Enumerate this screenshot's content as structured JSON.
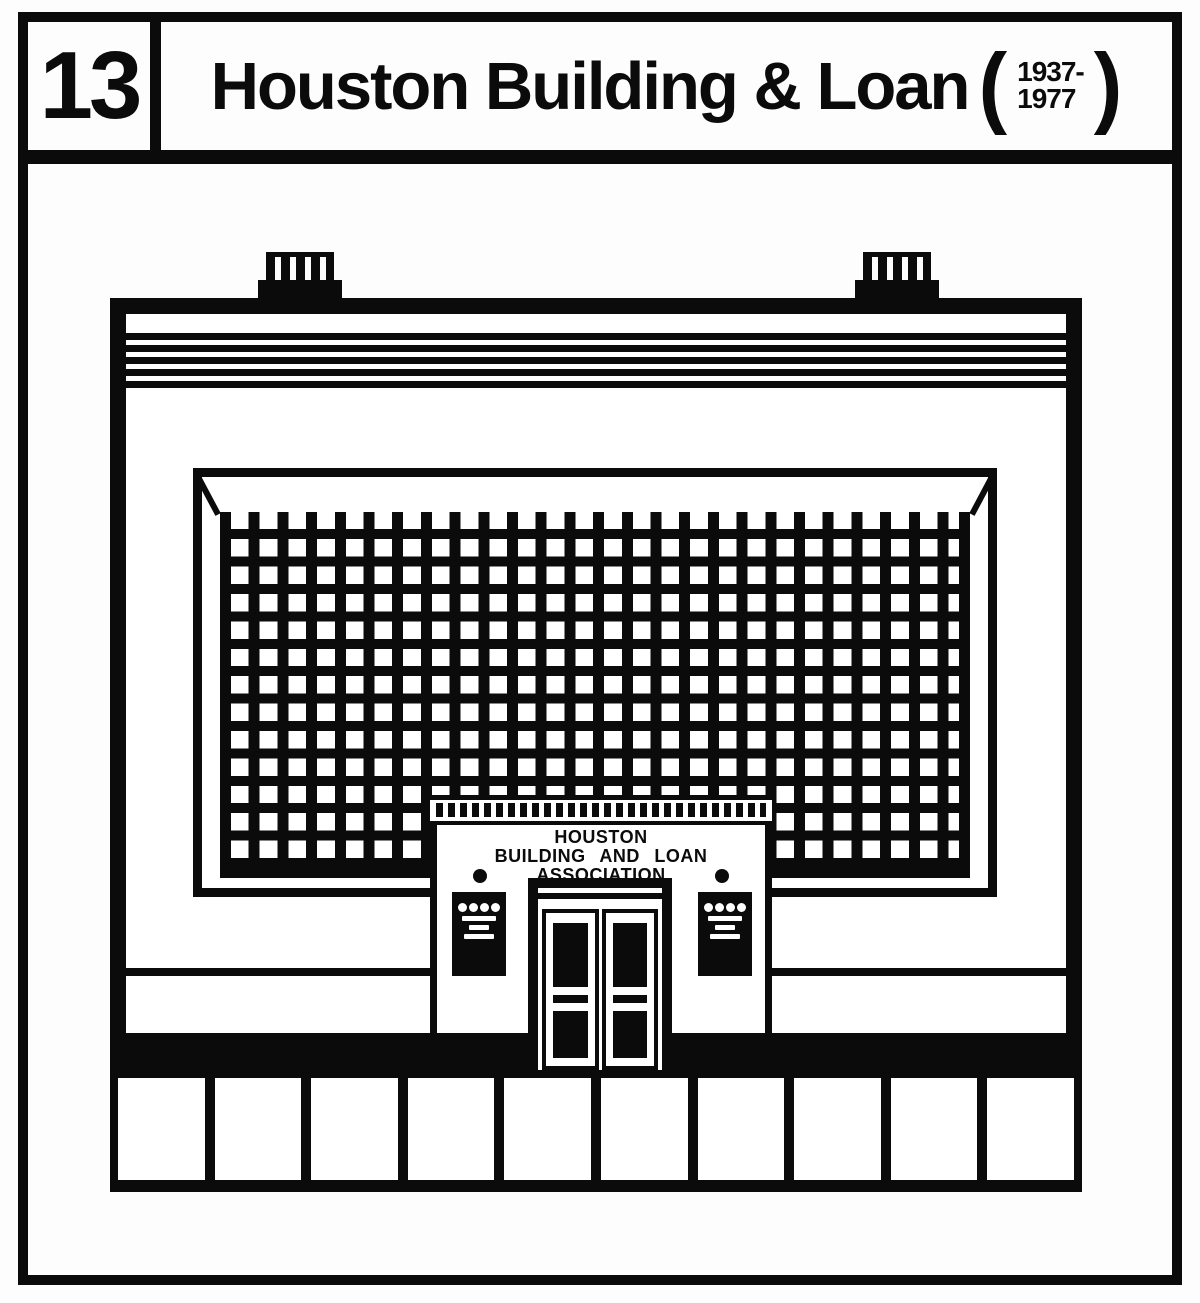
{
  "page": {
    "background": "#ffffff",
    "ink": "#0b0b0b"
  },
  "header": {
    "plate_number": "13",
    "title": "Houston Building & Loan",
    "paren_open": "(",
    "paren_close": ")",
    "years_top": "1937-",
    "years_bottom": "1977"
  },
  "building": {
    "sign": {
      "lines": [
        "HOUSTON",
        "BUILDING AND LOAN",
        "ASSOCIATION"
      ]
    },
    "roof": {
      "stripe_count": 5,
      "chimney_count": 2,
      "chimney_slat_count": 5
    },
    "window_grid": {
      "columns": 26,
      "rows": 13
    },
    "dentil_frieze": {
      "dentil_count": 27
    },
    "entrance": {
      "door_count": 2,
      "push_bars_per_door": 2,
      "lights_count": 2
    },
    "plaque": {
      "count": 2,
      "dot_count": 4,
      "fine_print_line_count": 3,
      "fine_print_legible": false
    },
    "storefront": {
      "panel_count": 10
    }
  }
}
